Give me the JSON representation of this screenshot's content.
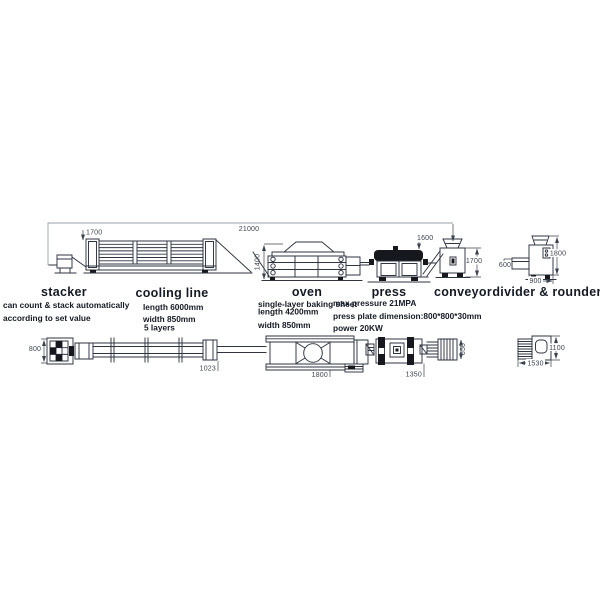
{
  "colors": {
    "line": "#2e3440",
    "ink": "#141923",
    "dim": "#3d434e",
    "dimlight": "#9aa0a6",
    "black": "#16181d",
    "bg": "#ffffff"
  },
  "diagram": {
    "machines": [
      {
        "id": "stacker",
        "label": "stacker",
        "specs": [
          "can count & stack automatically",
          "according to set value"
        ]
      },
      {
        "id": "cooling-line",
        "label": "cooling line",
        "specs": [
          "length 6000mm",
          "width 850mm",
          "5 layers"
        ]
      },
      {
        "id": "oven",
        "label": "oven",
        "specs": [
          "single-layer baking sheet",
          "length 4200mm",
          "width 850mm"
        ]
      },
      {
        "id": "press",
        "label": "press",
        "specs": [
          "max pressure 21MPA",
          "press plate dimension:800*800*30mm",
          "power 20KW"
        ]
      },
      {
        "id": "conveyor",
        "label": "conveyor",
        "specs": []
      },
      {
        "id": "divider-rounder",
        "label": "divider & rounder",
        "specs": []
      }
    ],
    "dims": {
      "total_length": "21000",
      "cooling_line_height": "1700",
      "oven_height": "1400",
      "press_height": "1600",
      "conveyor_height": "1700",
      "divider_height": "1800",
      "divider_inlet_height": "600",
      "divider_base_width": "900",
      "line_width": "800",
      "transfer_length": "1023",
      "oven_plan_length": "1800",
      "press_plan_length": "1350",
      "conveyor_plan_width": "650",
      "divider_plan_length": "1530",
      "divider_plan_width": "1100"
    }
  }
}
